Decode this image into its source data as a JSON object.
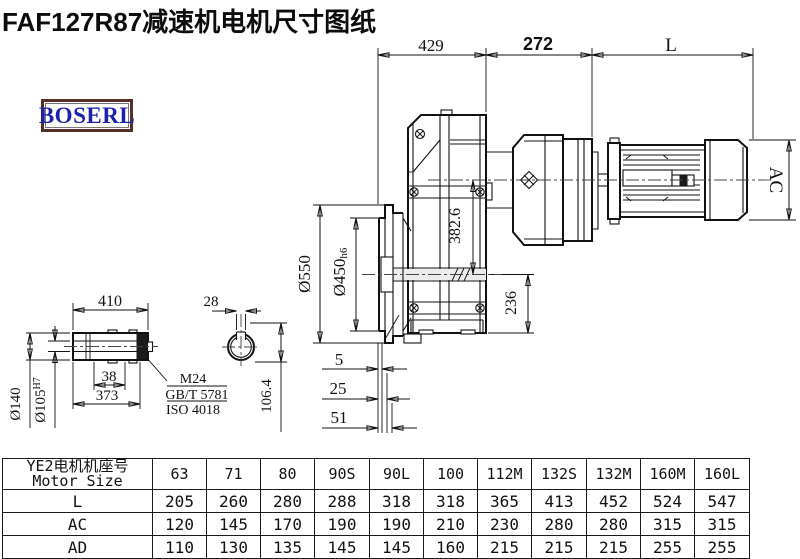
{
  "title": "FAF127R87减速机电机尺寸图纸",
  "logo": {
    "text": "BOSERL",
    "text_color": "#1e22aa",
    "border_color": "#533028"
  },
  "drawing": {
    "top_dims": {
      "left": "429",
      "middle": "272",
      "right": "L"
    },
    "motor": {
      "diameter_label": "AC"
    },
    "vertical_dims": {
      "axis_distance": "382.6",
      "axis_to_bottom": "236",
      "flange_od": "Ø550",
      "flange_spigot": "Ø450",
      "flange_spigot_tol": "h6"
    },
    "flange_steps": {
      "step1": "5",
      "step2": "25",
      "step3": "51"
    },
    "shaft_detail": {
      "length": "410",
      "od": "Ø140",
      "bore": "Ø105",
      "bore_tol": "H7",
      "key_offset": "38",
      "hub_length": "373",
      "thread": "M24",
      "standard1": "GB/T 5781",
      "standard2": "ISO 4018"
    },
    "section_detail": {
      "key_width": "28",
      "key_depth": "106.4"
    }
  },
  "table": {
    "header_line1": "YE2电机机座号",
    "header_line2": "Motor Size",
    "columns": [
      "63",
      "71",
      "80",
      "90S",
      "90L",
      "100",
      "112M",
      "132S",
      "132M",
      "160M",
      "160L"
    ],
    "rows": [
      {
        "label": "L",
        "values": [
          "205",
          "260",
          "280",
          "288",
          "318",
          "318",
          "365",
          "413",
          "452",
          "524",
          "547"
        ]
      },
      {
        "label": "AC",
        "values": [
          "120",
          "145",
          "170",
          "190",
          "190",
          "210",
          "230",
          "280",
          "280",
          "315",
          "315"
        ]
      },
      {
        "label": "AD",
        "values": [
          "110",
          "130",
          "135",
          "145",
          "145",
          "160",
          "215",
          "215",
          "215",
          "255",
          "255"
        ]
      }
    ]
  }
}
